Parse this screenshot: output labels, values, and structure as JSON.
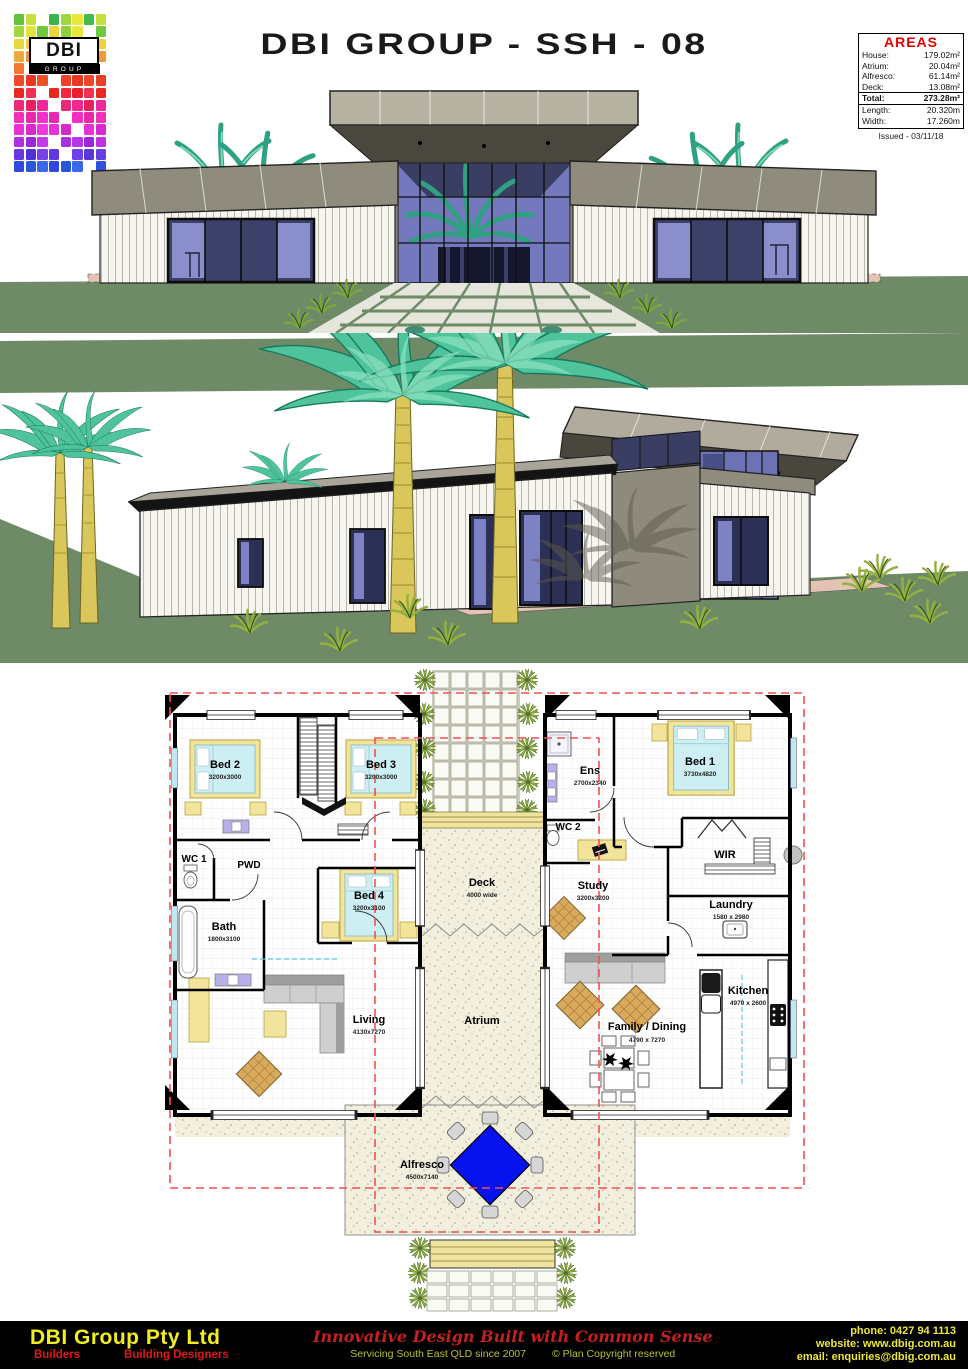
{
  "header": {
    "title": "DBI GROUP - SSH - 08",
    "logo": {
      "text": "DBI",
      "subtext": "GROUP",
      "grid": [
        [
          "#64c23c",
          "#c8e03c",
          null,
          "#3cb44c",
          "#a0d83c",
          "#e8e83c",
          "#44b84c",
          "#c8e03c"
        ],
        [
          "#a0d83c",
          "#e0e43c",
          "#70c83c",
          "#e8d83c",
          "#90d03c",
          "#e8e83c",
          null,
          "#70c83c"
        ],
        [
          "#e8d83c",
          "#f0c83c",
          "#e8e03c",
          "#f0b83c",
          "#e8d03c",
          "#f0c03c",
          "#e8c83c",
          "#f0d03c"
        ],
        [
          "#f0a83c",
          "#f09038",
          "#f0a038",
          "#e88834",
          "#f09838",
          "#f0a83c",
          "#e89034",
          "#f0983c"
        ],
        [
          "#f07834",
          null,
          "#f06830",
          "#e85830",
          "#f07030",
          "#f07834",
          "#e86030",
          null
        ],
        [
          "#f04828",
          "#e83824",
          "#f05028",
          null,
          "#f04028",
          "#e83824",
          "#f04828",
          "#e84028"
        ],
        [
          "#e82820",
          "#f03050",
          null,
          "#e82820",
          "#f02840",
          "#e82030",
          "#f03050",
          "#e82820"
        ],
        [
          "#f02878",
          "#e82060",
          "#f028a0",
          null,
          "#e82878",
          "#f02890",
          "#e82060",
          "#f028a0"
        ],
        [
          "#f030b8",
          "#e828a8",
          "#f030c8",
          "#e828b0",
          null,
          "#f030c0",
          "#e828a8",
          "#f030b8"
        ],
        [
          "#e830d8",
          "#d828d0",
          "#f038e0",
          "#e830d8",
          "#d828c8",
          null,
          "#e830d8",
          "#d828d0"
        ],
        [
          "#b030e0",
          "#9828d8",
          "#c838e8",
          null,
          "#a830e0",
          "#b838e8",
          "#9828d8",
          "#c030e0"
        ],
        [
          "#6838e0",
          "#5030d8",
          "#7840e8",
          "#6038e0",
          null,
          "#7040e8",
          "#5838d8",
          "#6840e0"
        ],
        [
          "#3048e0",
          "#2858d8",
          "#3868e8",
          "#3048e0",
          "#2858d8",
          "#3868e8",
          null,
          "#3050e0"
        ]
      ]
    },
    "areas": {
      "title": "AREAS",
      "rows": [
        {
          "label": "House:",
          "value": "179.02m²"
        },
        {
          "label": "Atrium:",
          "value": "20.04m²"
        },
        {
          "label": "Alfresco:",
          "value": "61.14m²"
        },
        {
          "label": "Deck:",
          "value": "13.08m²"
        },
        {
          "label": "Total:",
          "value": "273.28m²"
        },
        {
          "label": "Length:",
          "value": "20.320m"
        },
        {
          "label": "Width:",
          "value": "17.260m"
        }
      ],
      "issued": "Issued - 03/11/18"
    }
  },
  "plan": {
    "rooms": {
      "bed2": {
        "name": "Bed 2",
        "dims": "3200x3000"
      },
      "bed3": {
        "name": "Bed 3",
        "dims": "3200x3000"
      },
      "wc1": {
        "name": "WC 1"
      },
      "pwd": {
        "name": "PWD"
      },
      "bath": {
        "name": "Bath",
        "dims": "1800x3100"
      },
      "bed4": {
        "name": "Bed 4",
        "dims": "3200x3100"
      },
      "living": {
        "name": "Living",
        "dims": "4130x7270"
      },
      "deck": {
        "name": "Deck",
        "dims": "4000 wide"
      },
      "atrium": {
        "name": "Atrium"
      },
      "ens": {
        "name": "Ens",
        "dims": "2700x2340"
      },
      "wc2": {
        "name": "WC 2"
      },
      "bed1": {
        "name": "Bed 1",
        "dims": "3730x4820"
      },
      "wir": {
        "name": "WIR"
      },
      "study": {
        "name": "Study",
        "dims": "3200x3200"
      },
      "laundry": {
        "name": "Laundry",
        "dims": "1580 x 2980"
      },
      "kitchen": {
        "name": "Kitchen",
        "dims": "4970 x 2600"
      },
      "family": {
        "name": "Family / Dining",
        "dims": "4790 x 7270"
      },
      "alfresco": {
        "name": "Alfresco",
        "dims": "4500x7140"
      }
    }
  },
  "footer": {
    "company": "DBI Group Pty Ltd",
    "role1": "Builders",
    "role2": "Building Designers",
    "tagline": "Innovative Design Built with Common Sense",
    "servicing": "Servicing South East QLD since 2007",
    "copyright": "© Plan Copyright reserved",
    "phone": "phone: 0427 94 1113",
    "website": "website: www.dbig.com.au",
    "email": "email: enquiries@dbig.com.au"
  },
  "colors": {
    "accent_red": "#e00000",
    "footer_yellow": "#f2ee1e",
    "lawn_green": "#6f8a66",
    "palm_teal": "#4fc49c",
    "plan_red_dash": "#f25050",
    "plan_yellow": "#f2e49a",
    "bed_cyan": "#cdeef2",
    "alfresco_table_blue": "#0613ee"
  }
}
